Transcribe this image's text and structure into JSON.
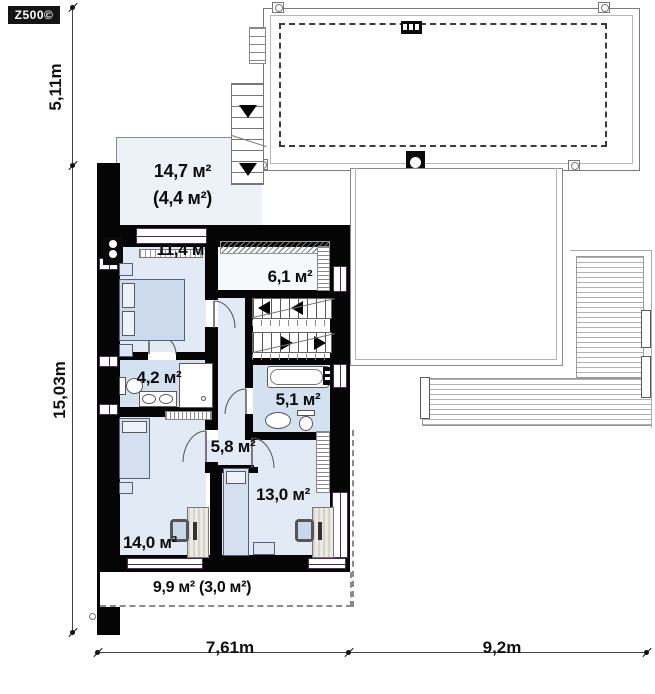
{
  "logo_text": "Z500©",
  "dimensions": {
    "left_upper": "5,11m",
    "left_lower": "15,03m",
    "bottom_left": "7,61m",
    "bottom_right": "9,2m"
  },
  "rooms": {
    "roof_terrace_top": {
      "area": "14,7 м²",
      "area_secondary": "(4,4 м²)"
    },
    "bedroom_upper": {
      "area": "11,4 м²"
    },
    "wardrobe": {
      "area": "6,1 м²"
    },
    "bathroom_small": {
      "area": "4,2 м²"
    },
    "bathroom_main": {
      "area": "5,1 м²"
    },
    "hall": {
      "area": "5,8 м²"
    },
    "bedroom_right": {
      "area": "13,0 м²"
    },
    "bedroom_lower": {
      "area": "14,0 м²"
    },
    "balcony": {
      "area": "9,9 м² (3,0 м²)"
    }
  },
  "colors": {
    "wall": "#050505",
    "room_fill": "#e1eaf5",
    "bath_fill": "#d3e1f1",
    "terrace_fill": "#edf2f9",
    "window_accent": "#4a2d4a",
    "outline_gray": "#8a8a8a"
  },
  "icons": [
    "stairs-exterior-icon",
    "stairs-interior-icon",
    "chimney-icon",
    "roof-vent-icon",
    "downspout-icon",
    "bed-double-icon",
    "bed-single-icon",
    "bathtub-icon",
    "toilet-icon",
    "sink-icon",
    "double-sink-icon",
    "shower-icon",
    "washer-icon",
    "desk-icon",
    "chair-icon",
    "door-arc-icon",
    "pergola-hatch-icon"
  ]
}
